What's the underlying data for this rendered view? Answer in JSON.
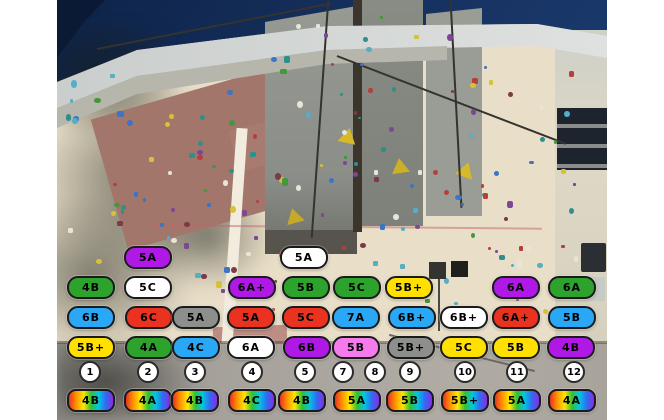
{
  "colors": {
    "purple": "#B018E6",
    "green": "#2DA32D",
    "blue": "#2AA7F5",
    "yellow": "#FFE000",
    "red": "#E9321F",
    "gray": "#8D8F8C",
    "white": "#FFFFFF",
    "pink": "#F57BEC",
    "rainbow_gradient": [
      "#E93223",
      "#FF9500",
      "#FFE600",
      "#2FC32F",
      "#00C8E0",
      "#2F6DF2",
      "#8A2BE2"
    ]
  },
  "overlay": {
    "route_grade_labels": [
      {
        "grade": "5A",
        "color": "purple",
        "x": 148,
        "y": 258
      },
      {
        "grade": "5A",
        "color": "white",
        "x": 304,
        "y": 258
      },
      {
        "grade": "4B",
        "color": "green",
        "x": 91,
        "y": 288
      },
      {
        "grade": "5C",
        "color": "white",
        "x": 148,
        "y": 288
      },
      {
        "grade": "6A+",
        "color": "purple",
        "x": 252,
        "y": 288
      },
      {
        "grade": "5B",
        "color": "green",
        "x": 306,
        "y": 288
      },
      {
        "grade": "5C",
        "color": "green",
        "x": 357,
        "y": 288
      },
      {
        "grade": "5B+",
        "color": "yellow",
        "x": 409,
        "y": 288
      },
      {
        "grade": "6A",
        "color": "purple",
        "x": 516,
        "y": 288
      },
      {
        "grade": "6A",
        "color": "green",
        "x": 572,
        "y": 288
      },
      {
        "grade": "6B",
        "color": "blue",
        "x": 91,
        "y": 318
      },
      {
        "grade": "6C",
        "color": "red",
        "x": 149,
        "y": 318
      },
      {
        "grade": "5A",
        "color": "gray",
        "x": 196,
        "y": 318
      },
      {
        "grade": "5A",
        "color": "red",
        "x": 251,
        "y": 318
      },
      {
        "grade": "5C",
        "color": "red",
        "x": 306,
        "y": 318
      },
      {
        "grade": "7A",
        "color": "blue",
        "x": 356,
        "y": 318
      },
      {
        "grade": "6B+",
        "color": "blue",
        "x": 412,
        "y": 318
      },
      {
        "grade": "6B+",
        "color": "white",
        "x": 464,
        "y": 318
      },
      {
        "grade": "6A+",
        "color": "red",
        "x": 516,
        "y": 318
      },
      {
        "grade": "5B",
        "color": "blue",
        "x": 572,
        "y": 318
      },
      {
        "grade": "5B+",
        "color": "yellow",
        "x": 91,
        "y": 348
      },
      {
        "grade": "4A",
        "color": "green",
        "x": 149,
        "y": 348
      },
      {
        "grade": "4C",
        "color": "blue",
        "x": 196,
        "y": 348
      },
      {
        "grade": "6A",
        "color": "white",
        "x": 251,
        "y": 348
      },
      {
        "grade": "6B",
        "color": "purple",
        "x": 307,
        "y": 348
      },
      {
        "grade": "5B",
        "color": "pink",
        "x": 356,
        "y": 348
      },
      {
        "grade": "5B+",
        "color": "gray",
        "x": 411,
        "y": 348
      },
      {
        "grade": "5C",
        "color": "yellow",
        "x": 464,
        "y": 348
      },
      {
        "grade": "5B",
        "color": "yellow",
        "x": 516,
        "y": 348
      },
      {
        "grade": "4B",
        "color": "purple",
        "x": 571,
        "y": 348
      }
    ],
    "lane_numbers": [
      {
        "number": "1",
        "x": 90,
        "y": 372
      },
      {
        "number": "2",
        "x": 148,
        "y": 372
      },
      {
        "number": "3",
        "x": 195,
        "y": 372
      },
      {
        "number": "4",
        "x": 252,
        "y": 372
      },
      {
        "number": "5",
        "x": 305,
        "y": 372
      },
      {
        "number": "7",
        "x": 343,
        "y": 372
      },
      {
        "number": "8",
        "x": 375,
        "y": 372
      },
      {
        "number": "9",
        "x": 410,
        "y": 372
      },
      {
        "number": "10",
        "x": 465,
        "y": 372
      },
      {
        "number": "11",
        "x": 517,
        "y": 372
      },
      {
        "number": "12",
        "x": 574,
        "y": 372
      }
    ],
    "circuit_grade_labels": [
      {
        "grade": "4B",
        "x": 91,
        "y": 401
      },
      {
        "grade": "4A",
        "x": 148,
        "y": 401
      },
      {
        "grade": "4B",
        "x": 195,
        "y": 401
      },
      {
        "grade": "4C",
        "x": 252,
        "y": 401
      },
      {
        "grade": "4B",
        "x": 302,
        "y": 401
      },
      {
        "grade": "5A",
        "x": 357,
        "y": 401
      },
      {
        "grade": "5B",
        "x": 410,
        "y": 401
      },
      {
        "grade": "5B+",
        "x": 465,
        "y": 401
      },
      {
        "grade": "5A",
        "x": 517,
        "y": 401
      },
      {
        "grade": "4A",
        "x": 572,
        "y": 401
      }
    ]
  }
}
